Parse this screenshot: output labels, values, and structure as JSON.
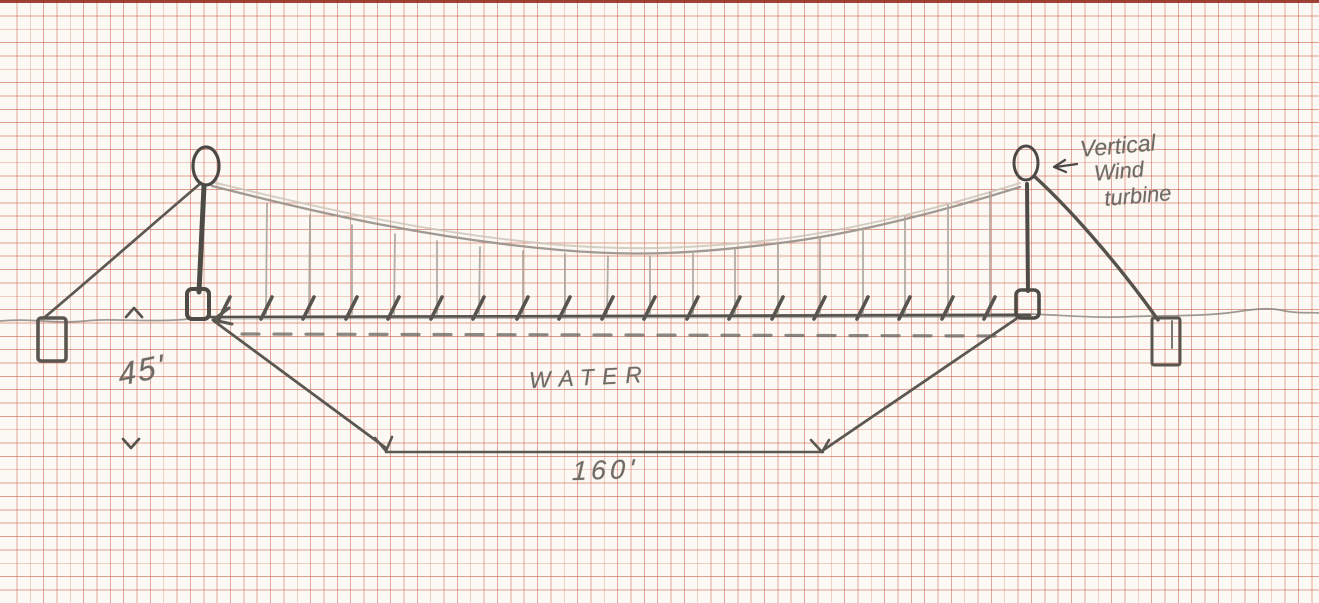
{
  "sketch": {
    "type": "hand-drawn suspension bridge concept on red graph paper",
    "labels": {
      "water": "WATER",
      "depth_dimension": "45'",
      "bottom_width_dimension": "160'",
      "turbine_note_line1": "Vertical",
      "turbine_note_line2": "Wind",
      "turbine_note_line3": "turbine"
    },
    "colors": {
      "grid_line": "#c7543f",
      "paper": "#fcf9f4",
      "pencil_dark": "#4e4a45",
      "pencil_mid": "#5b5751",
      "pencil_light": "#a9a39a"
    }
  }
}
